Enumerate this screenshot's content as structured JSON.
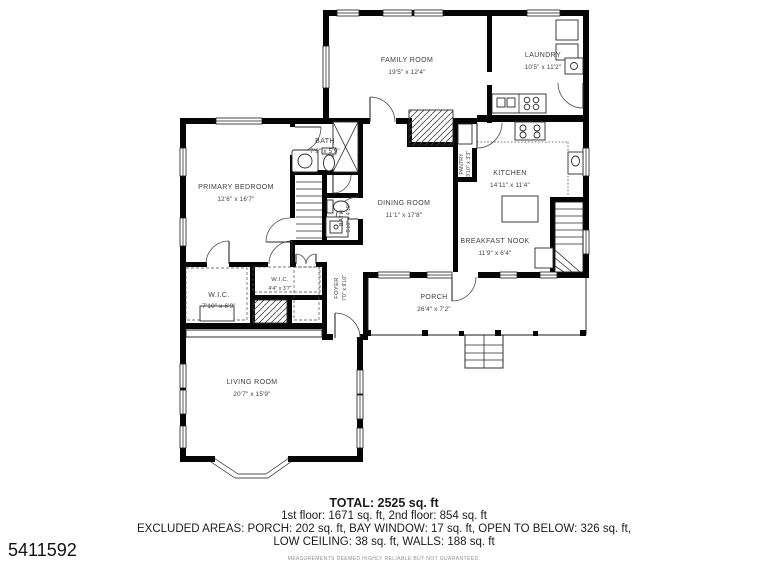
{
  "listing_id": "5411592",
  "rooms": [
    {
      "name": "FAMILY ROOM",
      "dims": "19'5\" x 12'4\""
    },
    {
      "name": "LAUNDRY",
      "dims": "10'5\" x 11'2\""
    },
    {
      "name": "BATH",
      "dims": "7'9\" x 5'9\""
    },
    {
      "name": "PRIMARY BEDROOM",
      "dims": "12'6\" x 16'7\""
    },
    {
      "name": "DINING ROOM",
      "dims": "11'1\" x 17'8\""
    },
    {
      "name": "KITCHEN",
      "dims": "14'11\" x 11'4\""
    },
    {
      "name": "PANTRY",
      "dims": "3'10\" x 3'3\""
    },
    {
      "name": "BATH",
      "dims": "5'10\" x 4'10\""
    },
    {
      "name": "BREAKFAST NOOK",
      "dims": "11'9\" x 6'4\""
    },
    {
      "name": "W.I.C.",
      "dims": "7'10\" x 6'9\""
    },
    {
      "name": "W.I.C.",
      "dims": "4'4\" x 3'7\""
    },
    {
      "name": "FOYER",
      "dims": "7'0\" x 9'10\""
    },
    {
      "name": "LIVING ROOM",
      "dims": "20'7\" x 15'9\""
    },
    {
      "name": "PORCH",
      "dims": "26'4\" x 7'2\""
    }
  ],
  "summary": {
    "total": "TOTAL: 2525 sq. ft",
    "floors": "1st floor: 1671 sq. ft, 2nd floor: 854 sq. ft",
    "excluded_line1": "EXCLUDED AREAS: PORCH: 202 sq. ft, BAY WINDOW: 17 sq. ft, OPEN TO BELOW: 326 sq. ft,",
    "excluded_line2": "LOW CEILING: 38 sq. ft, WALLS: 188 sq. ft",
    "disclaimer": "MEASUREMENTS DEEMED HIGHLY RELIABLE BUT NOT GUARANTEED."
  }
}
